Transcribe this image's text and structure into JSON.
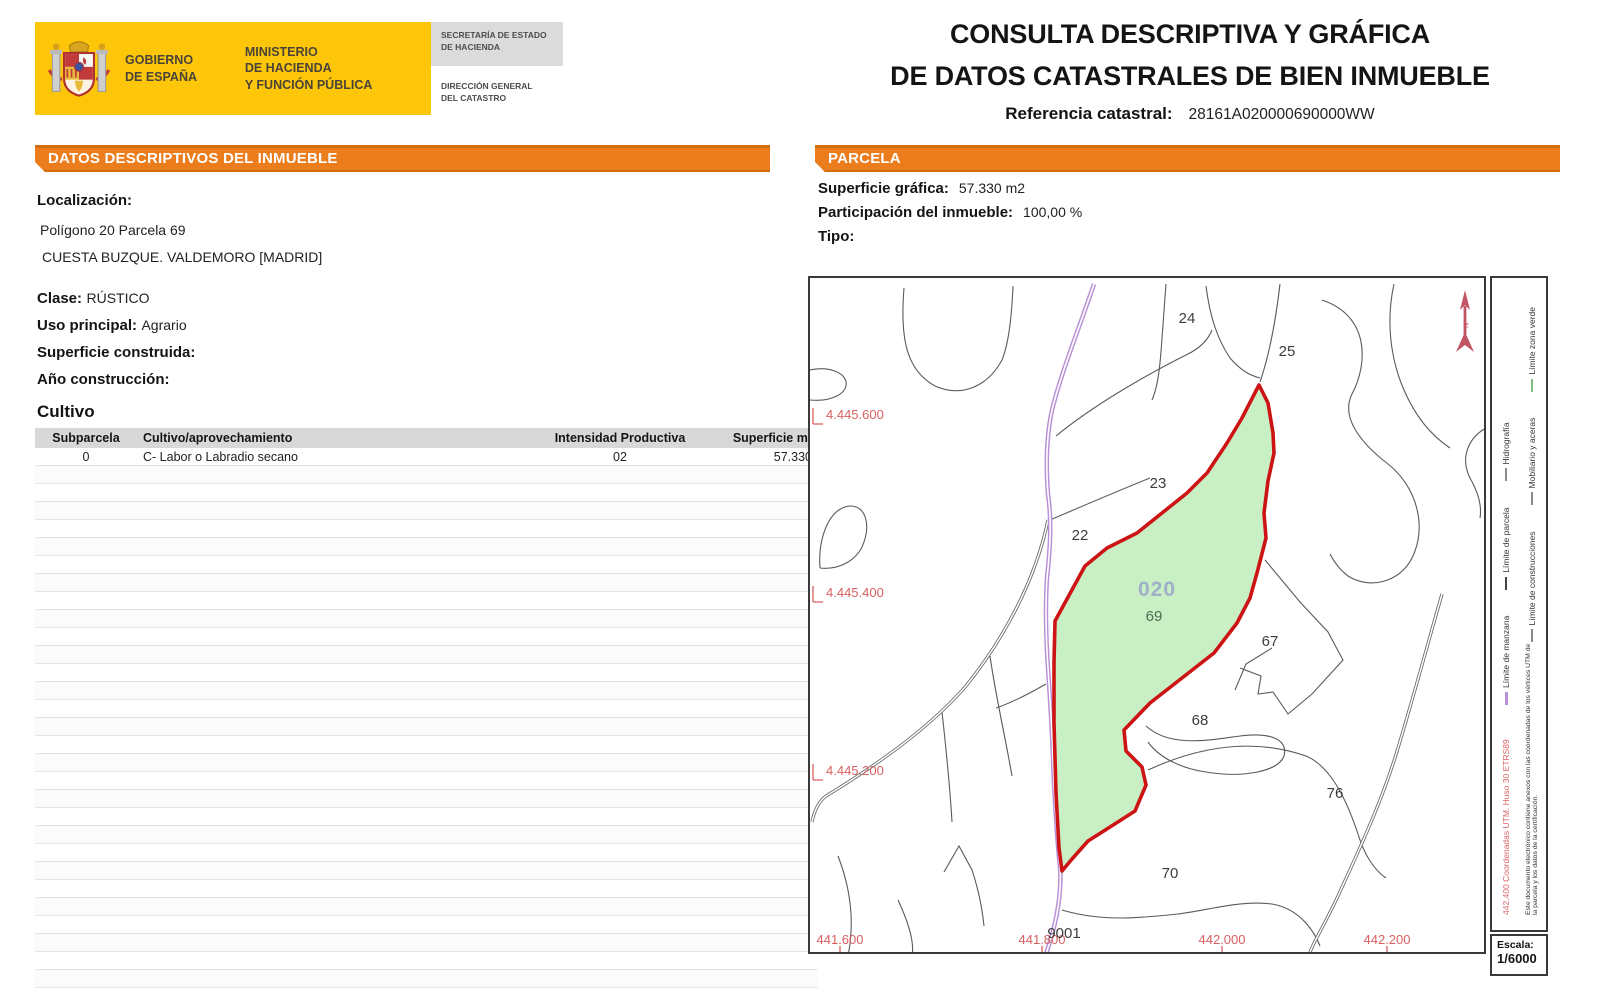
{
  "header": {
    "gobierno": "GOBIERNO\nDE ESPAÑA",
    "ministerio": "MINISTERIO\nDE HACIENDA\nY FUNCIÓN PÚBLICA",
    "secretaria": "SECRETARÍA DE ESTADO\nDE HACIENDA",
    "direccion": "DIRECCIÓN GENERAL\nDEL CATASTRO",
    "title_line1": "CONSULTA DESCRIPTIVA Y GRÁFICA",
    "title_line2": "DE DATOS CATASTRALES DE BIEN INMUEBLE",
    "ref_label": "Referencia catastral:",
    "ref_value": "28161A020000690000WW"
  },
  "datos": {
    "section_title": "DATOS DESCRIPTIVOS DEL INMUEBLE",
    "localizacion_label": "Localización:",
    "localizacion_line1": "Polígono 20 Parcela 69",
    "localizacion_line2": "CUESTA BUZQUE. VALDEMORO [MADRID]",
    "clase_label": "Clase:",
    "clase_value": "RÚSTICO",
    "uso_label": "Uso principal:",
    "uso_value": "Agrario",
    "superficie_label": "Superficie construida:",
    "superficie_value": "",
    "anio_label": "Año construcción:",
    "anio_value": "",
    "cultivo_title": "Cultivo",
    "cultivo_table": {
      "headers": [
        "Subparcela",
        "Cultivo/aprovechamiento",
        "Intensidad Productiva",
        "Superficie m²"
      ],
      "rows": [
        [
          "0",
          "C- Labor o Labradio secano",
          "02",
          "57.330"
        ]
      ],
      "empty_row_count": 30
    }
  },
  "parcela": {
    "section_title": "PARCELA",
    "superficie_label": "Superficie gráfica:",
    "superficie_value": "57.330 m2",
    "participacion_label": "Participación del inmueble:",
    "participacion_value": "100,00 %",
    "tipo_label": "Tipo:",
    "tipo_value": "",
    "map": {
      "labels": {
        "l24": "24",
        "l25": "25",
        "l23": "23",
        "l22": "22",
        "l67": "67",
        "l68": "68",
        "l76": "76",
        "l70": "70",
        "l9001": "9001"
      },
      "highlight": {
        "code": "020",
        "num": "69"
      },
      "coords_left": [
        "4.445.600",
        "4.445.400",
        "4.445.200"
      ],
      "coords_bottom": [
        "441.600",
        "441.800",
        "442.000",
        "442.200"
      ],
      "legend": {
        "coord_text": "442.400 Coordenadas UTM. Huso 30 ETRS89",
        "row_inner": [
          "Límite de manzana",
          "Límite de parcela",
          "Hidrografía"
        ],
        "row_outer": [
          "Límite de construcciones",
          "Mobiliario y aceras",
          "Límite zona verde"
        ],
        "disclaimer": "Este documento electrónico contiene anexos con las coordenadas de los vértices UTM de la parcela y los datos de la certificación."
      },
      "escala_label": "Escala:",
      "escala_value": "1/6000"
    }
  },
  "colors": {
    "accent_orange": "#EC7D1C",
    "accent_orange_dark": "#D26C0D",
    "logo_yellow": "#FDC609",
    "header_gray": "#DBDBDB",
    "table_header_gray": "#D8D8D8",
    "parcel_fill": "#C9EFC4",
    "parcel_border": "#CC1414",
    "manzana_purple": "#B98FD6",
    "coord_label_red": "#D96060",
    "highlight_code_blue": "#9FB0C8",
    "highlight_num_green": "#4F6B52",
    "boundary_gray": "#5A5A5A",
    "north_arrow_red": "#C25563"
  }
}
